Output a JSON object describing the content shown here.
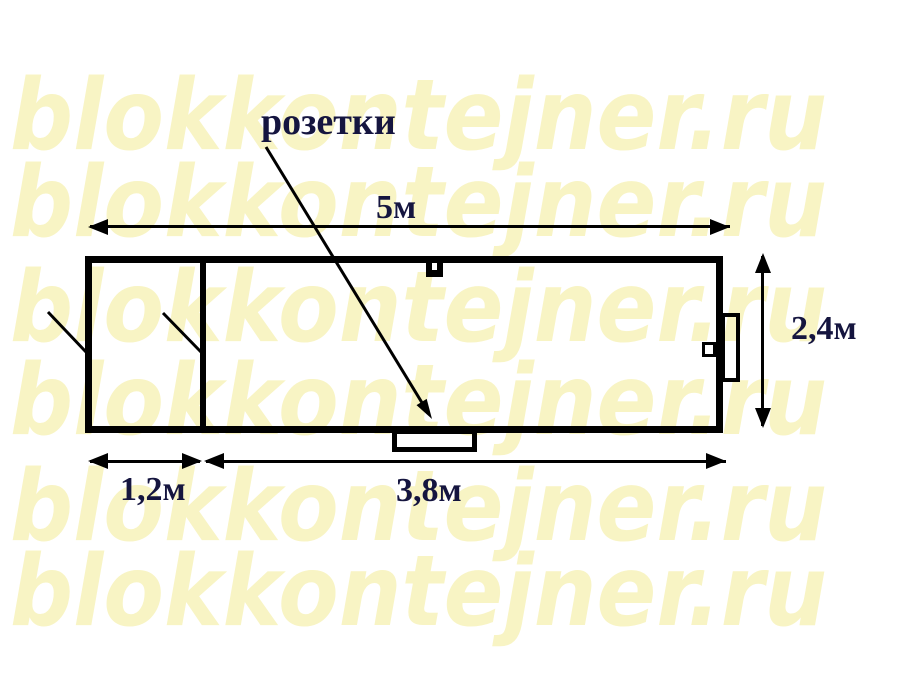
{
  "watermark": {
    "text": "blokkontejner.ru"
  },
  "diagram": {
    "labels": {
      "sockets": "розетки",
      "length_total": "5м",
      "height": "2,4м",
      "section_left": "1,2м",
      "section_right": "3,8м"
    },
    "colors": {
      "line": "#000000",
      "label": "#15153f",
      "watermark": "#f8f4c4"
    }
  }
}
